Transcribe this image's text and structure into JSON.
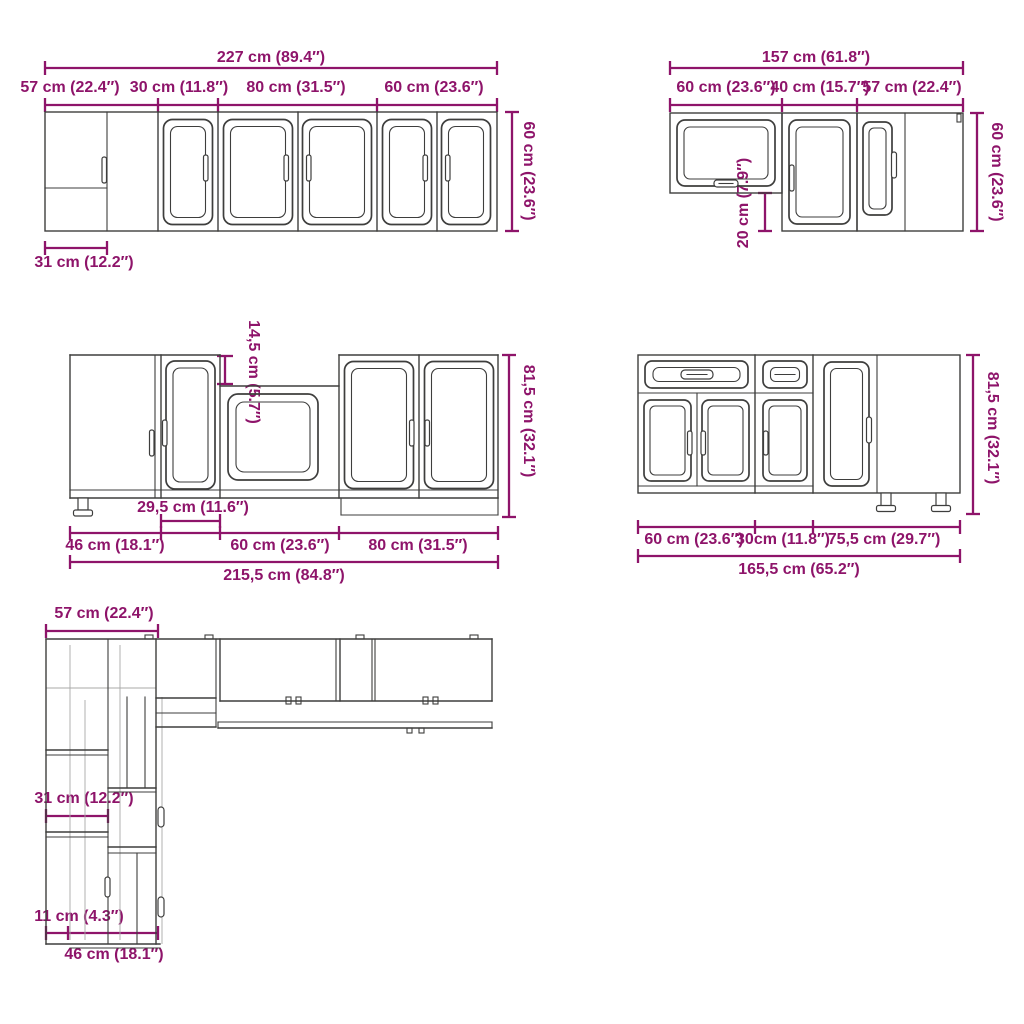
{
  "colors": {
    "dimension": "#8e146a",
    "cabinet_line": "#3e3e3d",
    "background": "#ffffff"
  },
  "drawings": {
    "wall_run_a": {
      "title": "upper wall cabinet run (front view)",
      "total_width": "227 cm (89.4″)",
      "seg1": "57 cm (22.4″)",
      "seg2": "30 cm (11.8″)",
      "seg3": "80 cm (31.5″)",
      "seg4": "60 cm (23.6″)",
      "height": "60 cm (23.6″)",
      "corner_inset": "31 cm (12.2″)"
    },
    "wall_run_b": {
      "title": "upper wall cabinet run (front view)",
      "total_width": "157 cm (61.8″)",
      "seg1": "60 cm (23.6″)",
      "seg2": "40 cm (15.7″)",
      "seg3": "57 cm (22.4″)",
      "height": "60 cm (23.6″)",
      "drop": "20 cm (7.9″)"
    },
    "base_run_a": {
      "title": "base cabinet run (front view)",
      "total_width": "215,5 cm (84.8″)",
      "seg1": "46 cm (18.1″)",
      "seg2": "60 cm (23.6″)",
      "seg3": "80 cm (31.5″)",
      "narrow_width": "29,5 cm (11.6″)",
      "recess_depth": "14,5 cm (5.7″)",
      "height": "81,5 cm (32.1″)"
    },
    "base_run_b": {
      "title": "base cabinet run (front view)",
      "total_width": "165,5 cm (65.2″)",
      "seg1": "60 cm (23.6″)",
      "seg2": "30cm (11.8″)",
      "seg3": "75,5 cm (29.7″)",
      "height": "81,5 cm (32.1″)"
    },
    "corner_view": {
      "title": "L-shaped corner layout view",
      "top_width": "57 cm (22.4″)",
      "mid_width": "31 cm (12.2″)",
      "small_width": "11 cm (4.3″)",
      "bottom_width": "46 cm (18.1″)"
    }
  }
}
